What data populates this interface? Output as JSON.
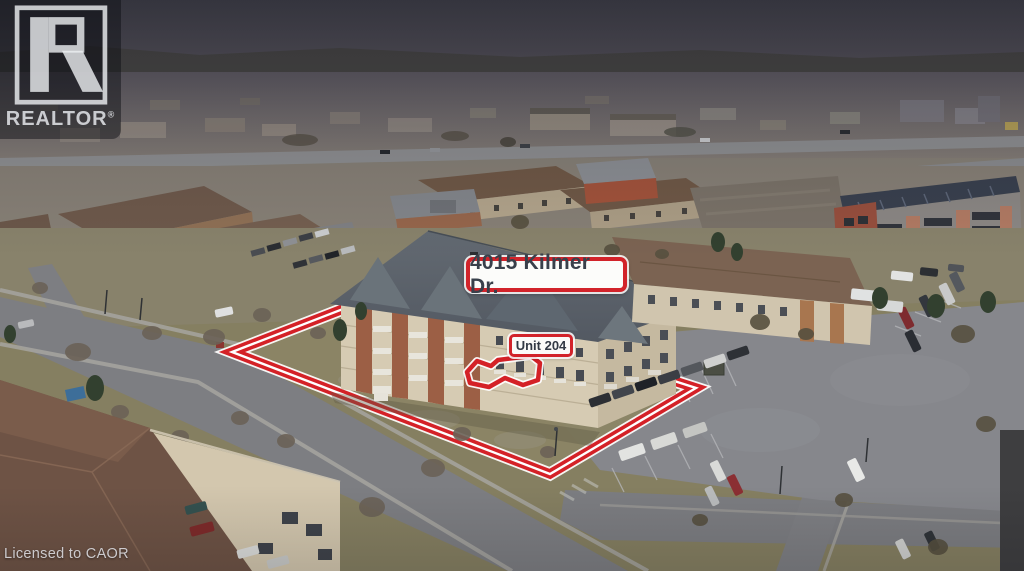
{
  "watermark": {
    "brand": "REALTOR",
    "reg": "®"
  },
  "annotations": {
    "address": "4015 Kilmer Dr.",
    "unit": "Unit 204",
    "license": "Licensed to CAOR"
  },
  "colors": {
    "annotation_red": "#d2232a",
    "label_background": "#fcfcfa",
    "label_text": "#39404b",
    "watermark_background": "rgba(8,10,15,0.45)",
    "watermark_text": "rgba(228,230,234,0.85)",
    "license_text": "rgba(222,222,226,0.88)"
  }
}
